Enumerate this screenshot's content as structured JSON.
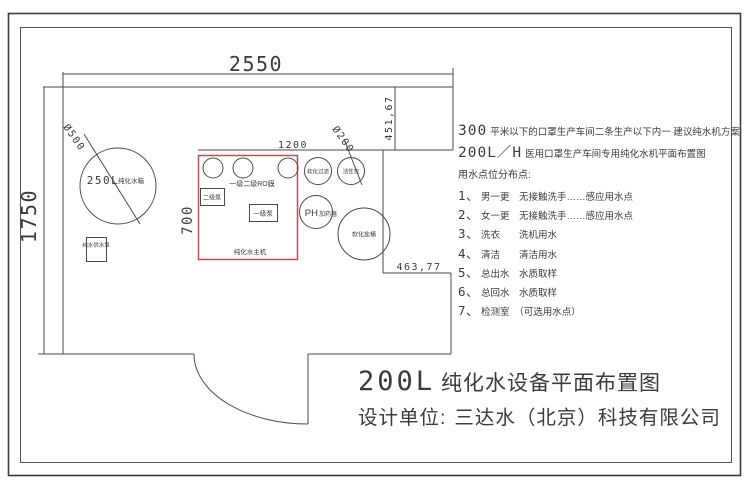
{
  "plan": {
    "dims": {
      "width": "2550",
      "height": "1750",
      "unit_width": "1200",
      "unit_height": "700",
      "right_top": "451,67",
      "right_mid": "463,77",
      "tank_diameter": "Ø500",
      "carbon_diameter": "Ø200"
    },
    "tank_big": "250L",
    "tank_small": "纯化水箱",
    "supply_pump": "纯水供水泵",
    "ro_membrane": "一级二级RO膜",
    "pump_stage2": "二级泵",
    "pump_stage1": "一级泵",
    "main_unit": "纯化水主机",
    "softener_filter": "软化过滤",
    "carbon": "活性炭",
    "ph_big": "PH",
    "ph_small": "加药器",
    "salt_barrel": "软化盐桶"
  },
  "notes": {
    "line1_big": "300",
    "line1_rest": "平米以下的口罩生产车间二条生产以下内一 建议纯水机方案",
    "line2_big": "200L／H",
    "line2_rest": "医用口罩生产车间专用纯化水机平面布置图",
    "line3": "用水点位分布点:",
    "items": [
      {
        "num": "1、",
        "text": "男一更　无接触洗手……感应用水点"
      },
      {
        "num": "2、",
        "text": "女一更　无接触洗手……感应用水点"
      },
      {
        "num": "3、",
        "text": "洗衣　　洗机用水"
      },
      {
        "num": "4、",
        "text": "清洁　　清洁用水"
      },
      {
        "num": "5、",
        "text": "总出水　水质取样"
      },
      {
        "num": "6、",
        "text": "总回水　水质取样"
      },
      {
        "num": "7、",
        "text": "检测室　（可选用水点）"
      }
    ]
  },
  "title": {
    "big": "200L",
    "rest": "纯化水设备平面布置图",
    "designer_label": "设计单位:",
    "designer_value": "三达水（北京）科技有限公司"
  },
  "colors": {
    "line": "#4a4a4a",
    "accent_red": "#c0504d",
    "text": "#3b3b3b"
  }
}
